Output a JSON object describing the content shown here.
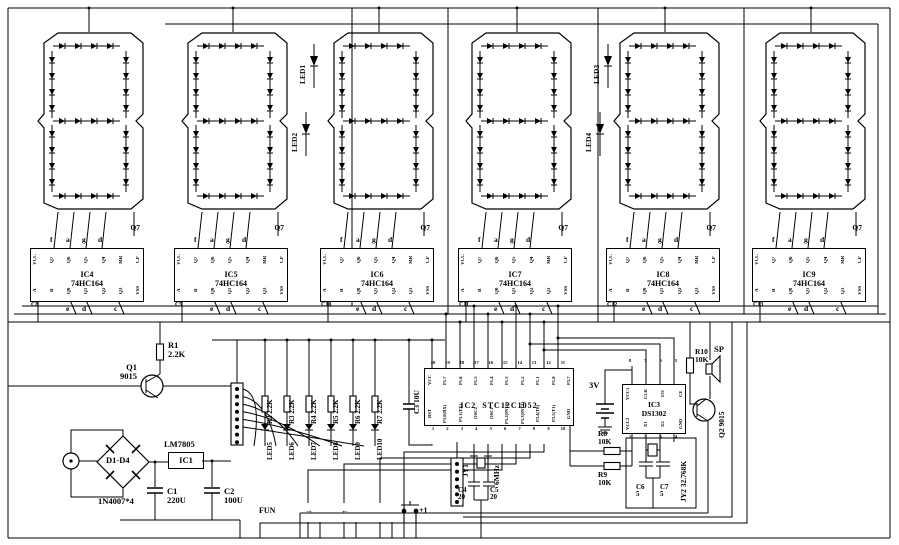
{
  "display": {
    "colon_leds": [
      {
        "label": "LED1"
      },
      {
        "label": "LED2"
      },
      {
        "label": "LED3"
      },
      {
        "label": "LED4"
      }
    ]
  },
  "shift_registers": {
    "chips": [
      {
        "ref": "IC4",
        "part": "74HC164",
        "cap": "C8"
      },
      {
        "ref": "IC5",
        "part": "74HC164",
        "cap": "C9"
      },
      {
        "ref": "IC6",
        "part": "74HC164",
        "cap": "C10"
      },
      {
        "ref": "IC7",
        "part": "74HC164",
        "cap": "C11"
      },
      {
        "ref": "IC8",
        "part": "74HC164",
        "cap": "C12"
      },
      {
        "ref": "IC9",
        "part": "74HC164",
        "cap": "C13"
      }
    ],
    "top_pins": [
      "VCC",
      "Q7",
      "Q6",
      "Q5",
      "Q4",
      "MR",
      "CP"
    ],
    "bottom_pins": [
      "A",
      "B",
      "Q0",
      "Q1",
      "Q2",
      "Q3",
      "VSS"
    ],
    "seg_top": [
      "f",
      "a",
      "g",
      "d"
    ],
    "seg_bottom": [
      "e",
      "d",
      "c"
    ],
    "cascade": "Q7"
  },
  "power": {
    "r1_ref": "R1",
    "r1_val": "2.2K",
    "q1_ref": "Q1",
    "q1_part": "9015",
    "bridge_ref": "D1-D4",
    "bridge_part": "1N4007*4",
    "reg_label": "LM7805",
    "reg_ref": "IC1",
    "c1_ref": "C1",
    "c1_val": "220U",
    "c2_ref": "C2",
    "c2_val": "100U"
  },
  "indicator_column": {
    "items": [
      {
        "res": "R2 2.2K",
        "led": "LED5"
      },
      {
        "res": "R3 2.2K",
        "led": "LED6"
      },
      {
        "res": "R4 2.2K",
        "led": "LED7"
      },
      {
        "res": "R5 2.2K",
        "led": "LED8"
      },
      {
        "res": "R6 2.2K",
        "led": "LED9"
      },
      {
        "res": "R7 2.2K",
        "led": "LED10"
      }
    ]
  },
  "mcu": {
    "ref": "IC2",
    "part": "STC12C1052",
    "rst_cap": "C3 10U",
    "top_pins": [
      "VCC",
      "P1.7",
      "P1.6",
      "P1.5",
      "P1.4",
      "P1.3",
      "P1.2",
      "P1.1",
      "P1.0",
      "P3.7"
    ],
    "top_nums": [
      "20",
      "19",
      "18",
      "17",
      "16",
      "15",
      "14",
      "13",
      "12",
      "11"
    ],
    "bottom_pins": [
      "RST",
      "P3.0(RX)",
      "P3.1(TX)",
      "OSC2",
      "OSC1",
      "P3.2(INT0)",
      "P3.3(INT1)",
      "P3.4(T0)",
      "P3.5(T1)",
      "GND"
    ],
    "bottom_nums": [
      "1",
      "2",
      "3",
      "4",
      "5",
      "6",
      "7",
      "8",
      "9",
      "10"
    ]
  },
  "xtal_main": {
    "ref": "JY1",
    "value": "6MHz",
    "c4_ref": "C4",
    "c4_val": "20",
    "c5_ref": "C5",
    "c5_val": "20"
  },
  "buttons": [
    {
      "label": "FUN"
    },
    {
      "label": "→"
    },
    {
      "label": "←"
    },
    {
      "label": "+1"
    }
  ],
  "rtc": {
    "ref": "IC3",
    "part": "DS1302",
    "battery": "3V",
    "top_pins": [
      "VCC1",
      "CLK",
      "I/O",
      "CE"
    ],
    "top_nums": [
      "8",
      "7",
      "6",
      "5"
    ],
    "bottom_pins": [
      "VCC2",
      "X1",
      "X2",
      "GND"
    ],
    "bottom_nums": [
      "1",
      "2",
      "3",
      "4"
    ],
    "r8_ref": "R8",
    "r8_val": "10K",
    "r9_ref": "R9",
    "r9_val": "10K",
    "xtal_ref": "JY2",
    "xtal_val": "32.768K",
    "c6_ref": "C6",
    "c6_val": "5",
    "c7_ref": "C7",
    "c7_val": "5"
  },
  "buzzer": {
    "r10_ref": "R10",
    "r10_val": "10K",
    "sp": "SP",
    "q2_ref": "Q2",
    "q2_part": "9015"
  }
}
